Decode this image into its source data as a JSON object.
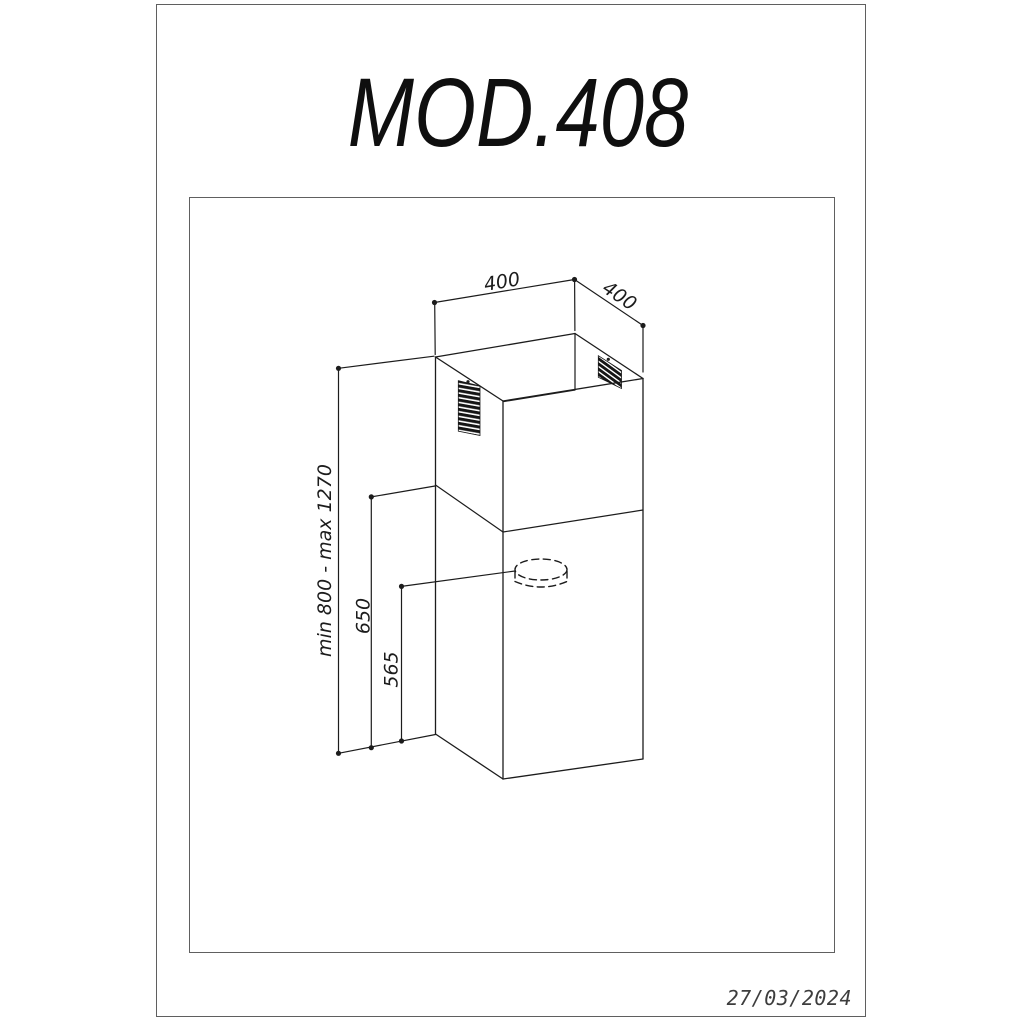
{
  "page": {
    "title": "MOD.408",
    "date_stamp": "27/03/2024"
  },
  "drawing": {
    "dimensions": {
      "top_width": "400",
      "top_depth": "400",
      "height_range": "min 800 - max 1270",
      "lower_section_height": "650",
      "outlet_height": "565"
    }
  },
  "colors": {
    "line": "#1c1c1c",
    "frame": "#5f5f5f",
    "background": "#ffffff"
  }
}
